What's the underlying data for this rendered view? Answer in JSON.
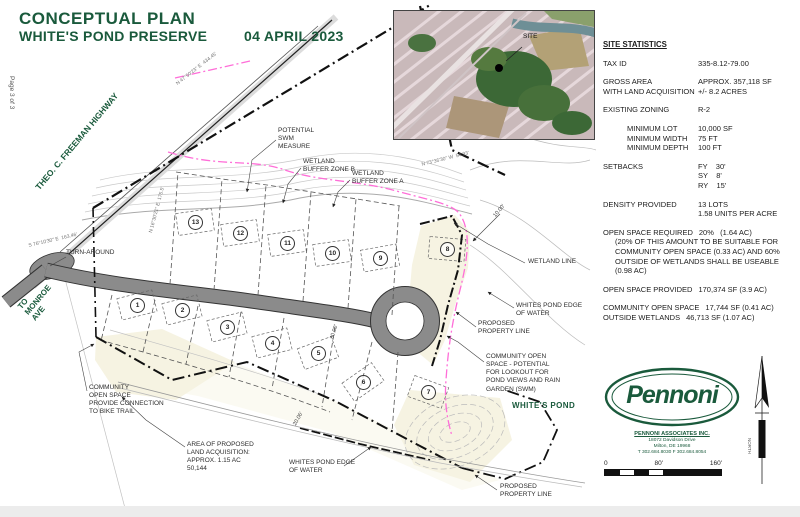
{
  "page": {
    "page_label": "Page 3 of 3"
  },
  "title_block": {
    "title": "CONCEPTUAL PLAN",
    "subtitle": "WHITE'S POND PRESERVE",
    "date": "04 APRIL 2023"
  },
  "inset": {
    "site_label": "SITE"
  },
  "plan": {
    "lots": [
      "1",
      "2",
      "3",
      "4",
      "5",
      "6",
      "7",
      "8",
      "9",
      "10",
      "11",
      "12",
      "13"
    ],
    "annotations": {
      "potential_swm": "POTENTIAL\nSWM\nMEASURE",
      "wetland_buffer_b": "WETLAND\nBUFFER ZONE B",
      "wetland_buffer_a": "WETLAND\nBUFFER ZONE A",
      "turn_around": "TURN-AROUND",
      "wetland_line": "WETLAND LINE",
      "whites_pond_edge_right": "WHITES POND EDGE\nOF WATER",
      "proposed_property_line_mid": "PROPOSED\nPROPERTY LINE",
      "community_open_space_lookout": "COMMUNITY OPEN\nSPACE - POTENTIAL\nFOR LOOKOUT FOR\nPOND VIEWS AND RAIN\nGARDEN (SWM)",
      "whites_pond": "WHITE'S POND",
      "community_open_space_bike": "COMMUNITY\nOPEN SPACE\nPROVIDE CONNECTION\nTO BIKE TRAIL",
      "land_acquisition": "AREA OF PROPOSED\nLAND ACQUISITION:\nAPPROX. 1.15 AC\n50,144",
      "whites_pond_edge_bottom": "WHITES POND EDGE\nOF WATER",
      "proposed_property_line_bottom": "PROPOSED\nPROPERTY LINE",
      "to_monroe_ave": "TO\nMONROE\nAVE",
      "freeman_highway": "THEO. C. FREEMAN HIGHWAY"
    },
    "dimensions": {
      "d1": "10.00'",
      "d2": "20.06'",
      "d3": "30.00'"
    },
    "bearings": {
      "b1": "N 47°50'23\" E  434.45'",
      "b2": "S 76°10'30\" E  163.46'",
      "b3": "N 16°30'21\" E  175.5'",
      "b4": "N 73°36'30\" W  54.93'"
    }
  },
  "stats": {
    "title": "SITE STATISTICS",
    "tax_id_label": "TAX ID",
    "tax_id": "335-8.12-79.00",
    "gross_label1": "GROSS AREA",
    "gross_value1": "APPROX. 357,118 SF",
    "gross_label2": "WITH LAND ACQUISITION",
    "gross_value2": "+/- 8.2 ACRES",
    "zoning_label": "EXISTING ZONING",
    "zoning": "R-2",
    "min_lot_label": "MINIMUM LOT",
    "min_lot": "10,000 SF",
    "min_width_label": "MINIMUM WIDTH",
    "min_width": "75 FT",
    "min_depth_label": "MINIMUM DEPTH",
    "min_depth": "100 FT",
    "setbacks_label": "SETBACKS",
    "setback_fy": "FY    30'",
    "setback_sy": "SY    8'",
    "setback_ry": "RY    15'",
    "density_label": "DENSITY PROVIDED",
    "density1": "13 LOTS",
    "density2": "1.58 UNITS PER ACRE",
    "osr_label": "OPEN SPACE REQUIRED",
    "osr_value": "20%   (1.64 AC)",
    "osr_note": "(20% OF THIS AMOUNT TO BE SUITABLE FOR COMMUNITY OPEN SPACE (0.33 AC) AND 60% OUTSIDE OF WETLANDS SHALL BE USEABLE (0.98 AC)",
    "osp_label": "OPEN SPACE PROVIDED",
    "osp_value": "170,374 SF (3.9 AC)",
    "cos_label": "COMMUNITY OPEN SPACE",
    "cos_value": "17,744 SF (0.41 AC)",
    "ow_label": "OUTSIDE WETLANDS",
    "ow_value": "46,713 SF (1.07 AC)"
  },
  "logo": {
    "wordmark": "Pennoni",
    "firm": "PENNONI ASSOCIATES INC.",
    "address1": "18072 Davidson Drive",
    "address2": "Milton, DE 19968",
    "phone": "T  302.684.8030     F  302.684.8054"
  },
  "scale_bar": {
    "zero": "0",
    "mid": "80'",
    "end": "160'"
  },
  "north": {
    "label": "NORTH"
  },
  "colors": {
    "accent_green": "#1A5A3C",
    "road_gray": "#8b8b8b",
    "wetland_magenta": "#ff6ed8",
    "open_space_cream": "#f6f3e2"
  }
}
